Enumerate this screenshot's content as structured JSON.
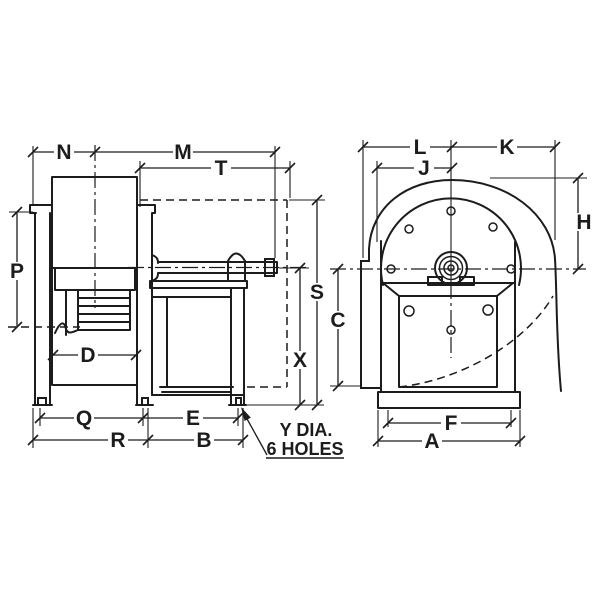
{
  "drawing": {
    "type": "engineering-dimension-drawing",
    "subject": "centrifugal-blower-two-views",
    "background_color": "#ffffff",
    "line_color": "#1c1c1c",
    "labels": {
      "n": "N",
      "m": "M",
      "t": "T",
      "p": "P",
      "d": "D",
      "q": "Q",
      "r": "R",
      "e": "E",
      "b": "B",
      "s": "S",
      "x": "X",
      "c": "C",
      "l": "L",
      "k": "K",
      "j": "J",
      "h": "H",
      "f": "F",
      "a": "A"
    },
    "note": {
      "line1": "Y DIA.",
      "line2": "6 HOLES"
    }
  }
}
